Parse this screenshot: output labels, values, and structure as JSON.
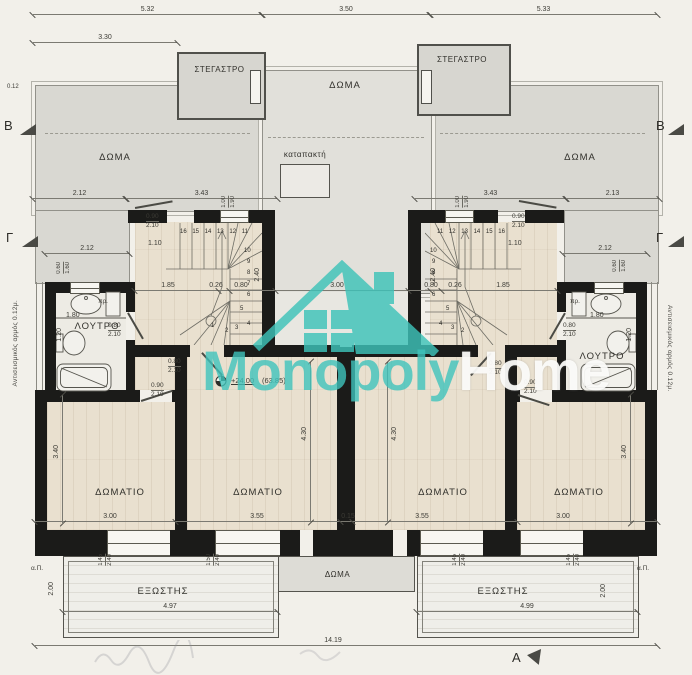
{
  "watermark": {
    "monopoly": "Monopoly",
    "home": "Home",
    "teal": "#3ec3b9"
  },
  "rooms": {
    "stegastro": "ΣΤΕΓΑΣΤΡΟ",
    "doma": "ΔΩΜΑ",
    "katapakti": "καταπακτή",
    "loutro": "ΛΟΥΤΡΟ",
    "domatio": "ΔΩΜΑΤΙΟ",
    "exostis": "ΕΞΩΣΤΗΣ"
  },
  "annotations": {
    "level": "+24.00",
    "level_abs": "(63.85)",
    "seismic": "Αντισεισμικός αρμός 0.12μ.",
    "pr": "πρ.",
    "ap": "α.Π."
  },
  "markers": {
    "b": "B",
    "g": "Γ",
    "a": "A"
  },
  "dims": {
    "d532": "5.32",
    "d350": "3.50",
    "d533": "5.33",
    "d330": "3.30",
    "d012": "0.12",
    "d212": "2.12",
    "d343": "3.43",
    "d213": "2.13",
    "d090": "0.90",
    "d210": "2.10",
    "d080": "0.80",
    "d110": "1.10",
    "d185": "1.85",
    "d026": "0.26",
    "d240": "2.40",
    "d300": "3.00",
    "d100": "1.00",
    "d190": "1.90",
    "d060": "0.60",
    "d160": "1.60",
    "d180": "1.80",
    "d120": "1.20",
    "d340": "3.40",
    "d430": "4.30",
    "d355": "3.55",
    "d015": "0.15",
    "d497": "4.97",
    "d499": "4.99",
    "d200": "2.00",
    "d145": "1.45",
    "d150": "1.50",
    "d1419": "14.19"
  },
  "stairs": {
    "left": {
      "row": "16 15 14 13 12 11",
      "c0": "10",
      "c1": "9",
      "c2": "8",
      "c3": "7",
      "c4": "6",
      "w0": "5",
      "w1": "4",
      "w2": "3",
      "w3": "2",
      "w4": "1"
    },
    "right": {
      "row": "11 12 13 14 15 16",
      "c0": "10",
      "c1": "9",
      "c2": "8",
      "c3": "7",
      "c4": "6",
      "w0": "5",
      "w1": "4",
      "w2": "3",
      "w3": "2"
    }
  }
}
